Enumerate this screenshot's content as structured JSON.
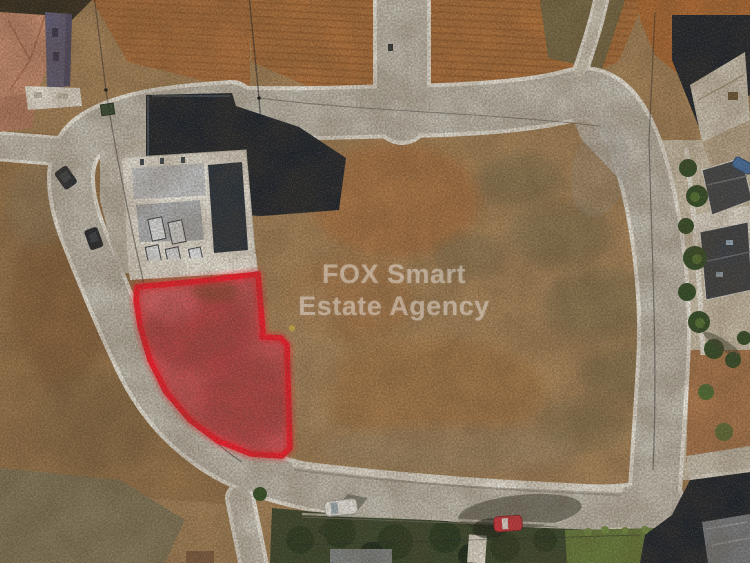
{
  "watermark": {
    "line1": "FOX Smart",
    "line2": "Estate Agency"
  },
  "colors": {
    "watermark_color": "rgba(255,255,255,0.36)",
    "plot_outline": "#f1192b",
    "plot_glow": "#ff2333",
    "plot_fill": "#c65055",
    "road": "#c1beb4",
    "curb": "#ebe9e1",
    "field_tan": "#a5835a",
    "field_orange": "#b0713c",
    "scrub_gray": "#8d7a5b",
    "shadow_navy": "#18202b",
    "building_white": "#e7e4db",
    "roof_terracotta": "#c78c70",
    "roof_charcoal": "#3c424a",
    "garden_green": "#34452c",
    "lawn_green": "#627d3c",
    "car_red": "#cf3340",
    "car_blue": "#3f6fa8",
    "car_white": "#f2f2f0"
  }
}
